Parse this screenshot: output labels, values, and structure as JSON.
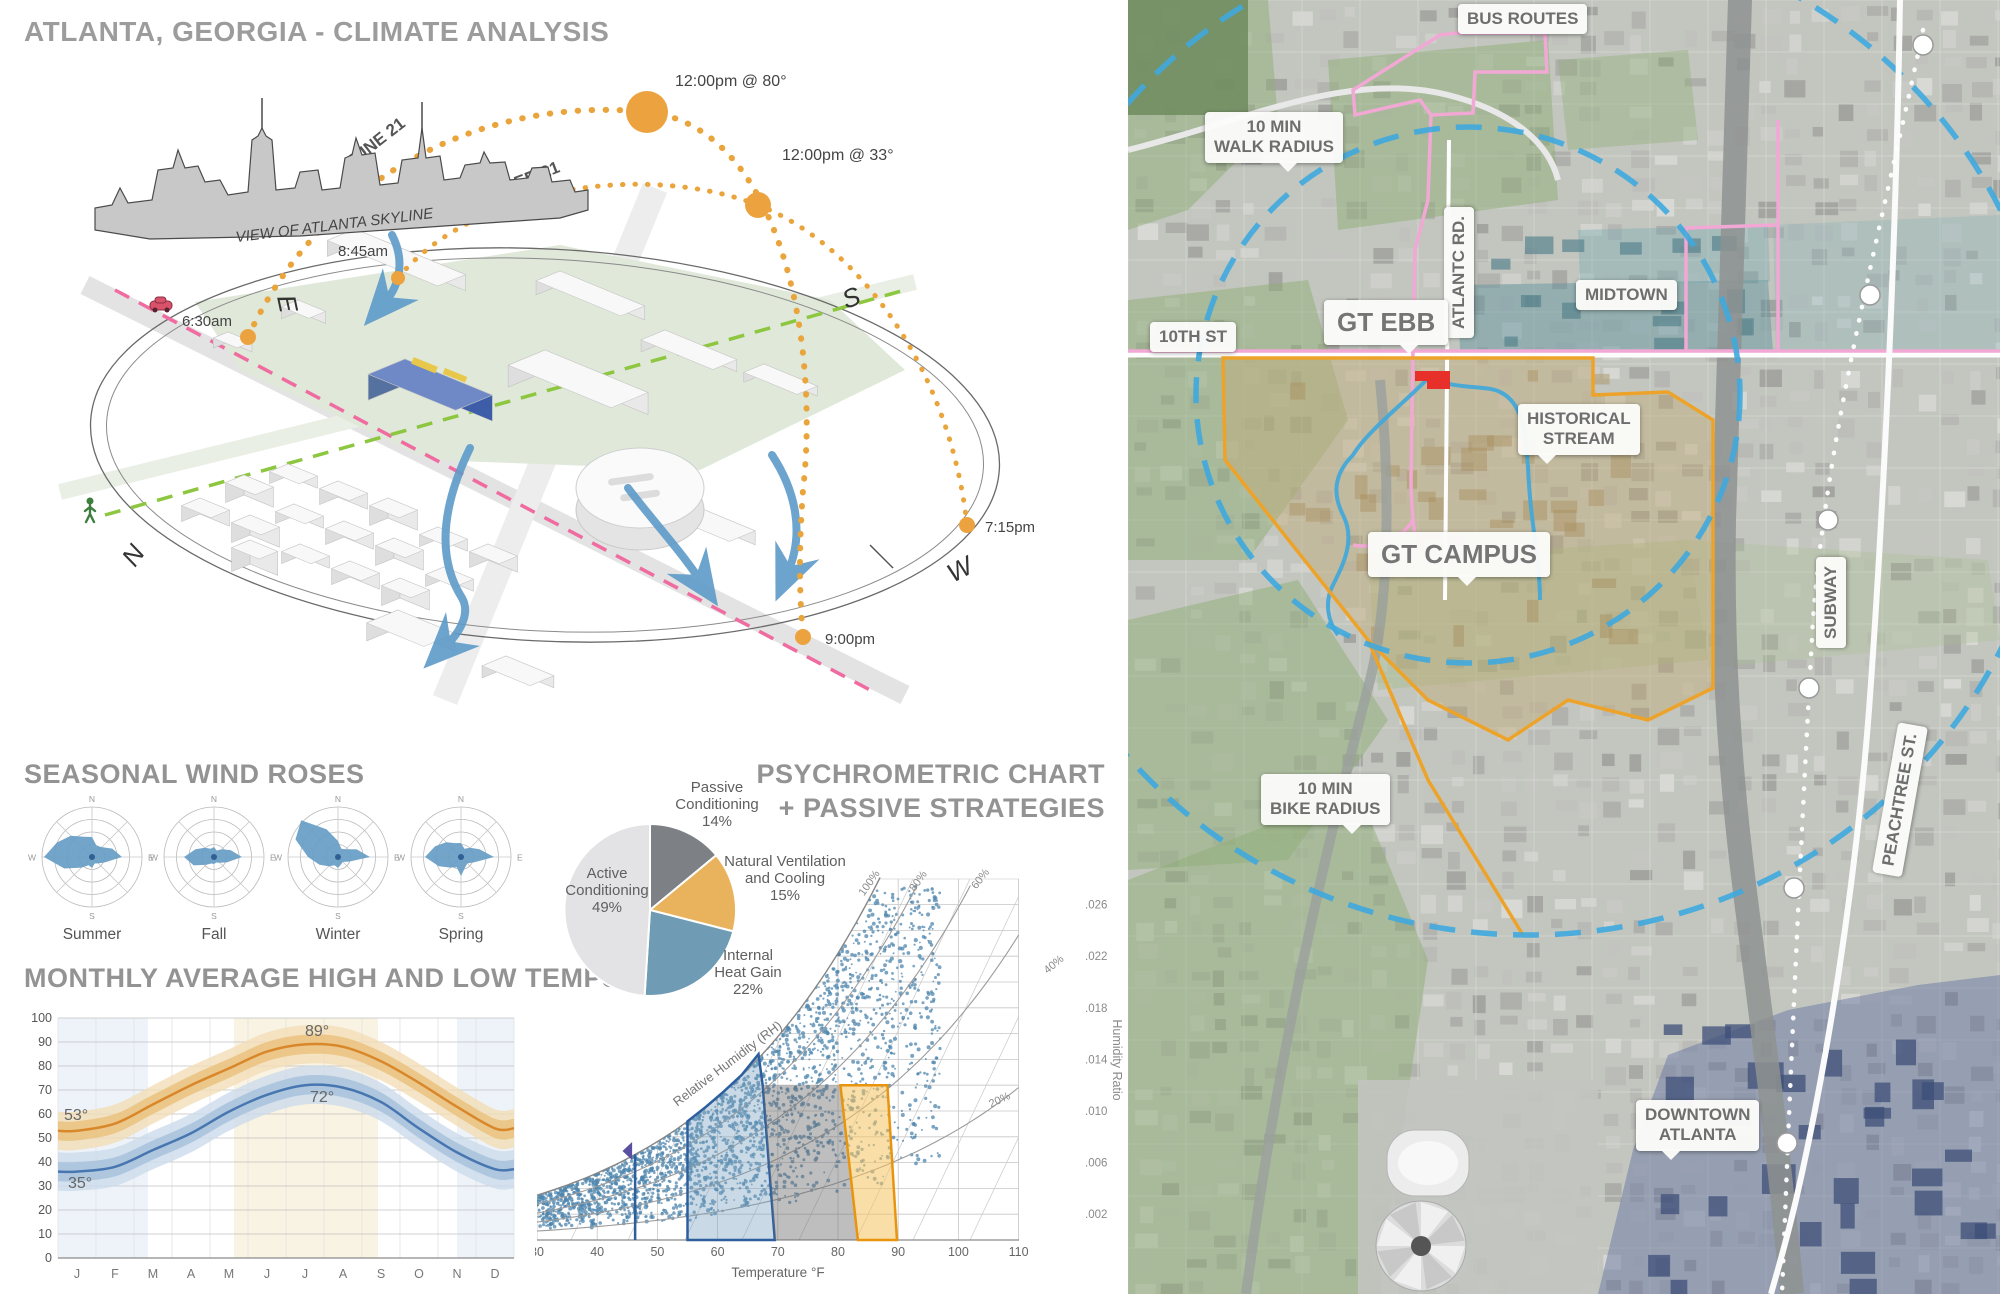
{
  "page_title": "ATLANTA, GEORGIA - CLIMATE ANALYSIS",
  "sun_diagram": {
    "skyline_caption": "VIEW OF ATLANTA SKYLINE",
    "june_arc_label": "JUNE 21",
    "december_arc_label": "DECEMBER 21",
    "sun_noon_summer": "12:00pm @ 80°",
    "sun_noon_winter": "12:00pm @ 33°",
    "sunrise_summer": "6:30am",
    "sunrise_winter": "8:45am",
    "sunset_winter": "7:15pm",
    "sunset_summer": "9:00pm",
    "compass": {
      "n": "N",
      "e": "E",
      "s": "S",
      "w": "W"
    },
    "sun_color": "#e9a43c"
  },
  "wind_roses": {
    "heading": "SEASONAL WIND ROSES",
    "compass": {
      "n": "N",
      "e": "E",
      "s": "S",
      "w": "W"
    }
  },
  "temps": {
    "heading": "MONTHLY AVERAGE HIGH AND LOW TEMPS",
    "annotations": {
      "high_peak": "89°",
      "low_peak": "72°",
      "high_jan": "53°",
      "low_jan": "35°"
    }
  },
  "psychrometric": {
    "heading_line1": "PSYCHROMETRIC CHART",
    "heading_line2": "+ PASSIVE STRATEGIES",
    "xlabel": "Temperature °F",
    "ylabel": "Humidity Ratio",
    "rh_curve_label": "Relative Humidity (RH)"
  },
  "chart_data": [
    {
      "type": "line",
      "title": "MONTHLY AVERAGE HIGH AND LOW TEMPS",
      "categories": [
        "J",
        "F",
        "M",
        "A",
        "M",
        "J",
        "J",
        "A",
        "S",
        "O",
        "N",
        "D"
      ],
      "ylim": [
        0,
        100
      ],
      "yticks": [
        100,
        90,
        80,
        70,
        60,
        50,
        40,
        30,
        20,
        10,
        0
      ],
      "series": [
        {
          "name": "Average High °F",
          "color": "#d9872b",
          "values": [
            53,
            56,
            64,
            72,
            79,
            86,
            89,
            88,
            82,
            73,
            63,
            54
          ]
        },
        {
          "name": "Average Low °F",
          "color": "#4876b0",
          "values": [
            36,
            38,
            45,
            52,
            61,
            68,
            72,
            71,
            65,
            54,
            44,
            37
          ]
        }
      ],
      "normal_spread": 4,
      "record_spread": 8,
      "annotated_values": {
        "high_peak": 89,
        "low_peak": 72,
        "high_jan": 53,
        "low_jan": 35
      }
    },
    {
      "type": "pie",
      "title": "PASSIVE STRATEGIES",
      "slices": [
        {
          "label": "Passive Conditioning",
          "value_pct": 14,
          "color": "#7d8084",
          "label_lines": [
            "Passive",
            "Conditioning",
            "14%"
          ]
        },
        {
          "label": "Natural Ventilation and Cooling",
          "value_pct": 15,
          "color": "#e9b25c",
          "label_lines": [
            "Natural Ventilation",
            "and Cooling",
            "15%"
          ]
        },
        {
          "label": "Internal Heat Gain",
          "value_pct": 22,
          "color": "#6f9cb4",
          "label_lines": [
            "Internal",
            "Heat Gain",
            "22%"
          ]
        },
        {
          "label": "Active Conditioning",
          "value_pct": 49,
          "color": "#e3e3e5",
          "label_lines": [
            "Active",
            "Conditioning",
            "49%"
          ]
        }
      ]
    },
    {
      "type": "scatter",
      "title": "PSYCHROMETRIC CHART + PASSIVE STRATEGIES",
      "xlabel": "Temperature °F",
      "ylabel": "Humidity Ratio",
      "xlim": [
        30,
        110
      ],
      "xticks": [
        30,
        40,
        50,
        60,
        70,
        80,
        90,
        100,
        110
      ],
      "yticks": [
        ".002",
        ".006",
        ".010",
        ".014",
        ".018",
        ".022",
        ".026"
      ],
      "rh_curve_labels": [
        "100%",
        "80%",
        "60%",
        "40%",
        "20%"
      ],
      "rh_curves_pct": [
        100,
        80,
        60,
        40,
        20
      ],
      "points_note": "dense blue dots = hourly Atlanta climate observations",
      "zones": [
        {
          "name": "Natural Ventilation and Cooling",
          "stroke": "#2d5f9f",
          "fill": "rgba(120,160,190,0.40)",
          "polygon_T_w": [
            [
              55,
              0
            ],
            [
              55,
              0.0092
            ],
            [
              58,
              0.0103
            ],
            [
              61,
              0.0115
            ],
            [
              64,
              0.0128
            ],
            [
              66.8,
              0.0144
            ],
            [
              67.5,
              0.012
            ],
            [
              69.5,
              0
            ]
          ]
        },
        {
          "name": "Internal Heat Gain",
          "stroke": "none",
          "fill": "rgba(110,110,112,0.45)",
          "polygon_T_w": [
            [
              69.5,
              0
            ],
            [
              67.5,
              0.012
            ],
            [
              80.4,
              0.012
            ],
            [
              83.3,
              0
            ]
          ]
        },
        {
          "name": "Passive Conditioning",
          "stroke": "#e8940f",
          "fill": "rgba(245,195,95,0.55)",
          "polygon_T_w": [
            [
              83.3,
              0
            ],
            [
              80.4,
              0.012
            ],
            [
              88.2,
              0.012
            ],
            [
              89.8,
              0
            ]
          ]
        }
      ],
      "marker_line_T": 46.3
    },
    {
      "type": "wind-rose",
      "directions": 16,
      "seasons": [
        {
          "name": "Summer",
          "radii": [
            20,
            12,
            14,
            22,
            30,
            14,
            9,
            7,
            11,
            9,
            15,
            30,
            48,
            38,
            30,
            22
          ]
        },
        {
          "name": "Fall",
          "radii": [
            10,
            7,
            11,
            18,
            28,
            14,
            8,
            6,
            7,
            7,
            11,
            22,
            30,
            20,
            13,
            9
          ]
        },
        {
          "name": "Winter",
          "radii": [
            16,
            9,
            11,
            20,
            32,
            12,
            7,
            8,
            11,
            9,
            13,
            20,
            30,
            46,
            52,
            30
          ]
        },
        {
          "name": "Spring",
          "radii": [
            14,
            9,
            13,
            20,
            33,
            14,
            9,
            11,
            19,
            11,
            15,
            24,
            36,
            28,
            21,
            15
          ]
        }
      ]
    }
  ],
  "map": {
    "labels": {
      "bus_routes": "BUS ROUTES",
      "walk_radius": [
        "10 MIN",
        "WALK RADIUS"
      ],
      "atlantic_rd": "ATLANTC RD.",
      "midtown": "MIDTOWN",
      "tenth_st": "10TH ST",
      "gt_ebb": "GT EBB",
      "historical_stream": [
        "HISTORICAL",
        "STREAM"
      ],
      "gt_campus": "GT CAMPUS",
      "subway": "SUBWAY",
      "bike_radius": [
        "10 MIN",
        "BIKE RADIUS"
      ],
      "peachtree": "PEACHTREE ST.",
      "downtown": [
        "DOWNTOWN",
        "ATLANTA"
      ]
    },
    "colors": {
      "radius_dashed": "#3fa9de",
      "campus_boundary": "#eda32a",
      "bus_route_line": "#f2a8d4",
      "stream": "#45a8d8",
      "site_highlight": "#e8302a"
    }
  }
}
